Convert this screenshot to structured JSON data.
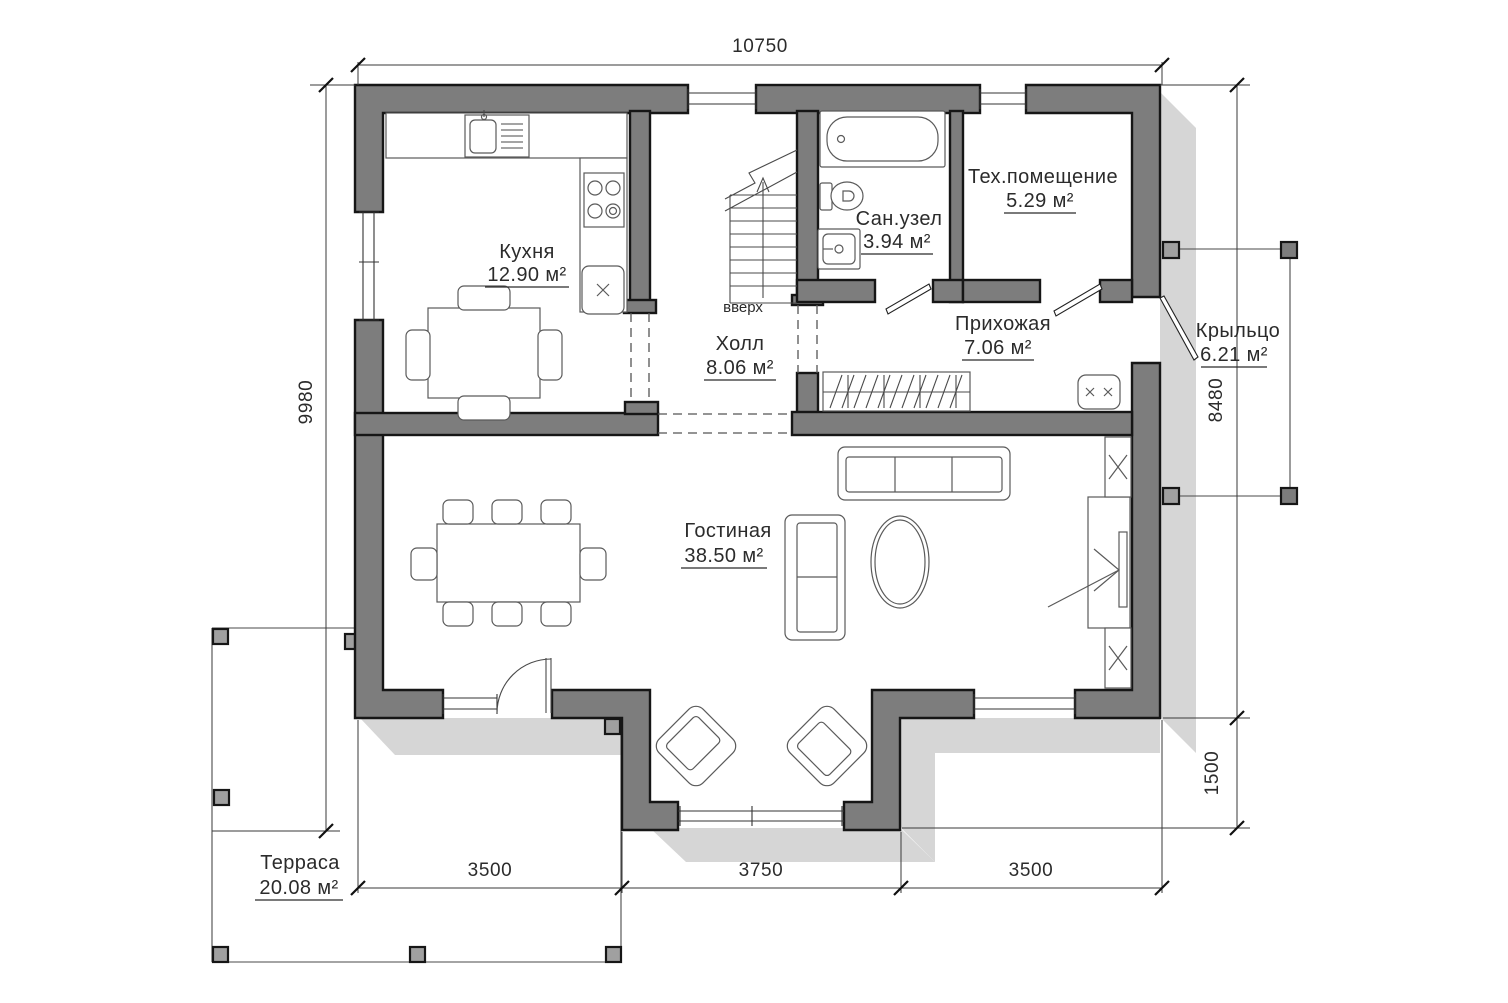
{
  "plan": {
    "rooms": {
      "kitchen": {
        "name": "Кухня",
        "area": "12.90 м²"
      },
      "hall": {
        "name": "Холл",
        "area": "8.06 м²"
      },
      "bathroom": {
        "name": "Сан.узел",
        "area": "3.94 м²"
      },
      "tech": {
        "name": "Тех.помещение",
        "area": "5.29 м²"
      },
      "entry": {
        "name": "Прихожая",
        "area": "7.06 м²"
      },
      "living": {
        "name": "Гостиная",
        "area": "38.50 м²"
      },
      "porch": {
        "name": "Крыльцо",
        "area": "6.21 м²"
      },
      "terrace": {
        "name": "Терраса",
        "area": "20.08 м²"
      }
    },
    "stairs": {
      "direction_label": "вверх"
    },
    "dimensions": {
      "top": "10750",
      "left": "9980",
      "right_upper": "8480",
      "right_lower": "1500",
      "bottom_left": "3500",
      "bottom_middle": "3750",
      "bottom_right": "3500"
    },
    "colors": {
      "wall": "#7d7d7d",
      "shadow": "#d6d6d6",
      "outline": "#161616",
      "dimension_line": "#3a3a3a",
      "text": "#2b2b2b",
      "background": "#ffffff"
    }
  }
}
